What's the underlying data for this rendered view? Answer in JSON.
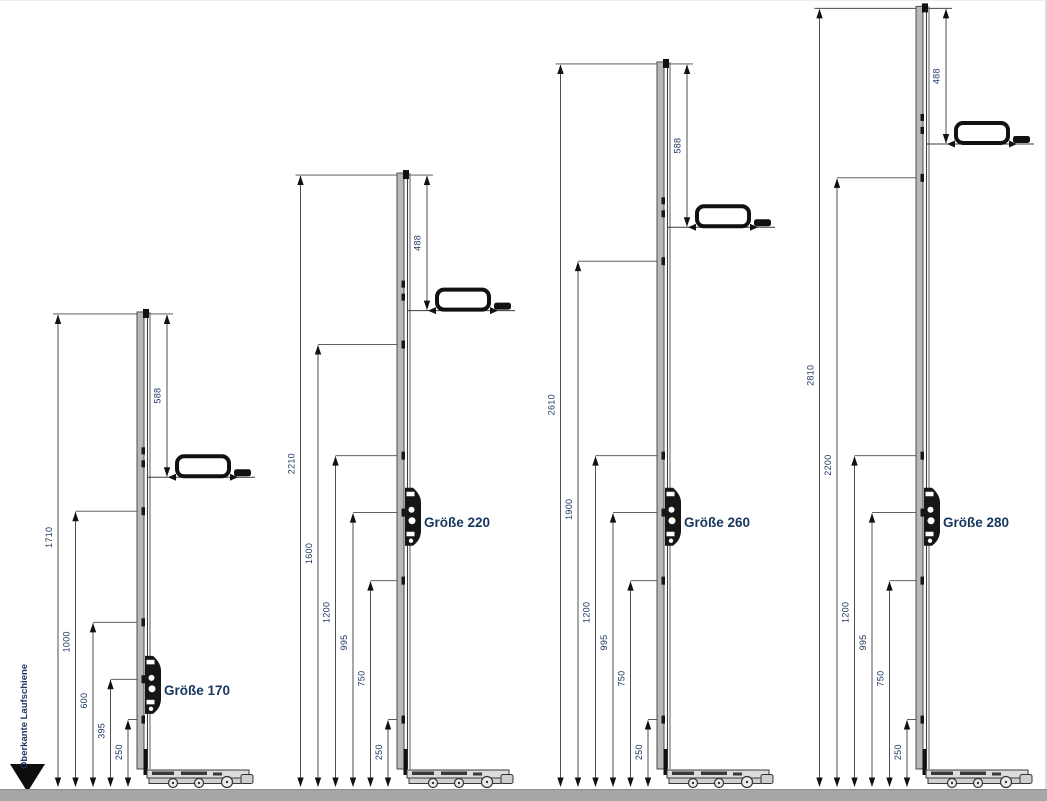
{
  "drawing": {
    "datum_label": "Oberkante Laufschiene",
    "colors": {
      "dimension_text": "#1F3864",
      "size_label_text": "#17365D",
      "line": "#2A2A2A",
      "ground_bar": "#A6A6A6"
    },
    "groups": [
      {
        "label": "Größe 170",
        "total_height": 1710,
        "handle_offset_from_top": 588,
        "height_marks": [
          1710,
          1000,
          600,
          395,
          250
        ]
      },
      {
        "label": "Größe 220",
        "total_height": 2210,
        "handle_offset_from_top": 488,
        "height_marks": [
          2210,
          1600,
          1200,
          995,
          750,
          250
        ]
      },
      {
        "label": "Größe 260",
        "total_height": 2610,
        "handle_offset_from_top": 588,
        "height_marks": [
          2610,
          1900,
          1200,
          995,
          750,
          250
        ]
      },
      {
        "label": "Größe 280",
        "total_height": 2810,
        "handle_offset_from_top": 488,
        "height_marks": [
          2810,
          2200,
          1200,
          995,
          750,
          250
        ]
      }
    ]
  }
}
